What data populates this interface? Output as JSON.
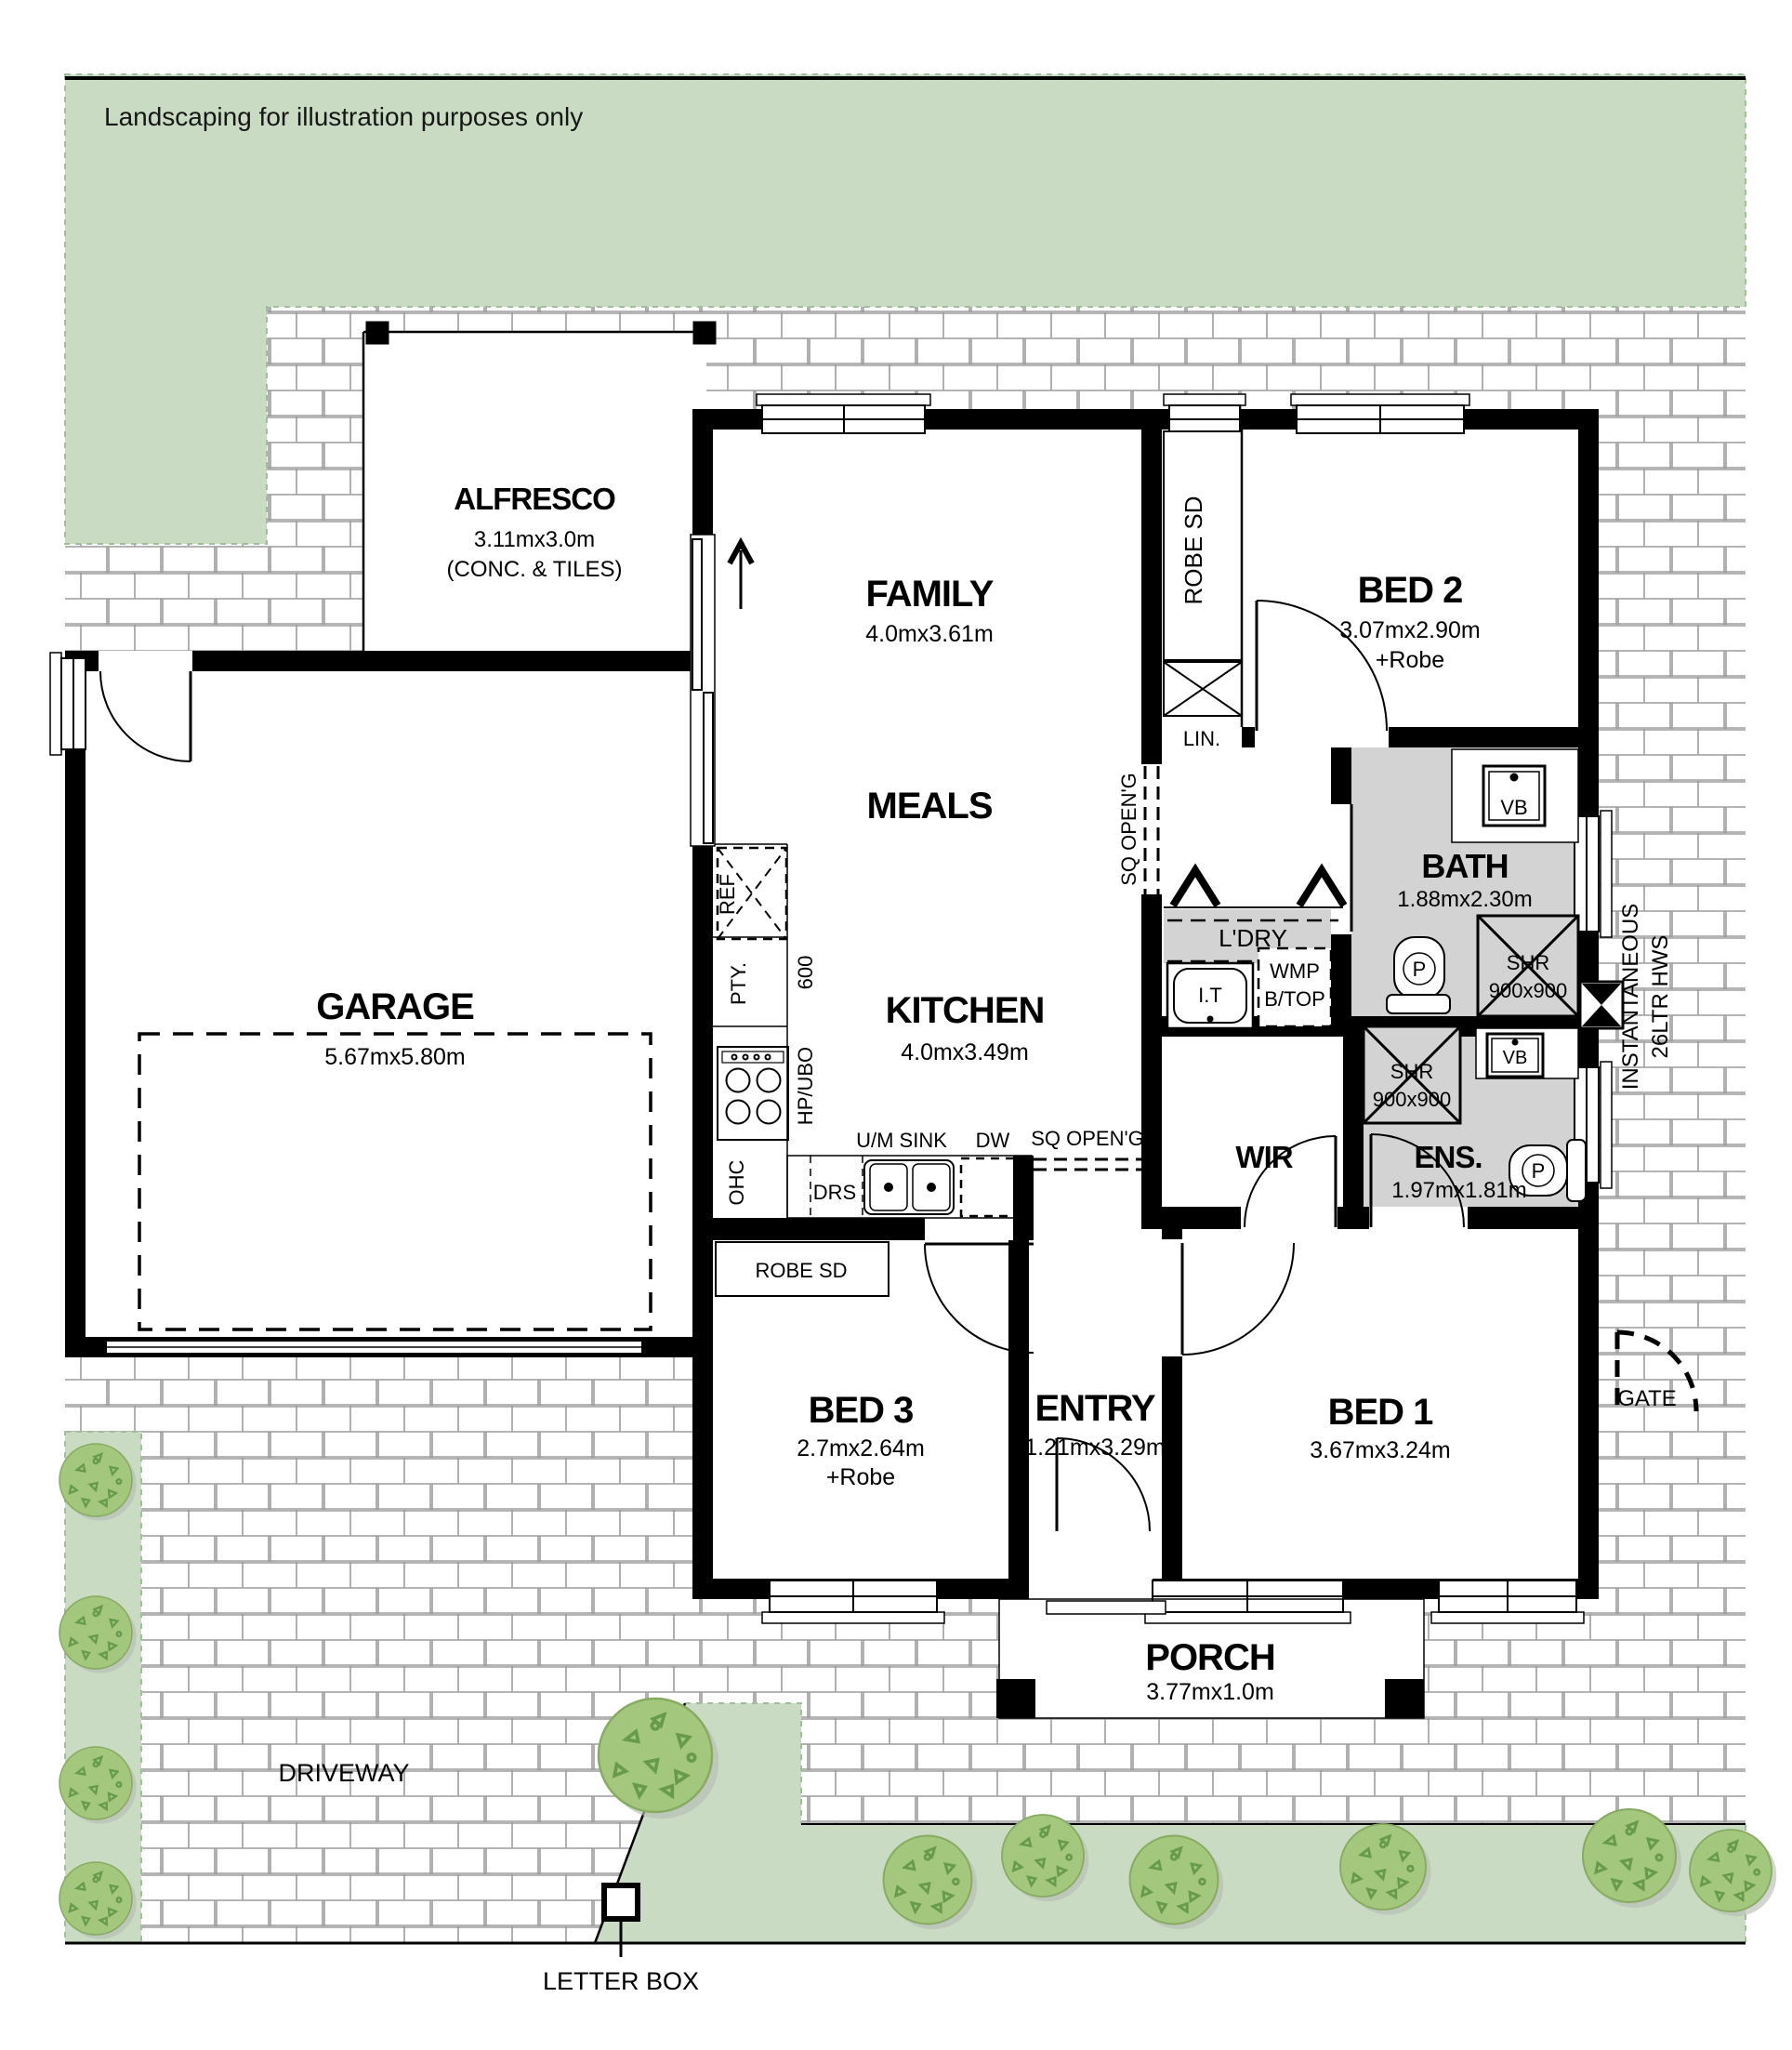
{
  "page": {
    "landscaping_note": "Landscaping for illustration purposes only"
  },
  "rooms": {
    "alfresco": {
      "name": "ALFRESCO",
      "dims": "3.11mx3.0m",
      "note": "(CONC. & TILES)"
    },
    "family": {
      "name": "FAMILY",
      "dims": "4.0mx3.61m"
    },
    "meals": {
      "name": "MEALS"
    },
    "kitchen": {
      "name": "KITCHEN",
      "dims": "4.0mx3.49m"
    },
    "garage": {
      "name": "GARAGE",
      "dims": "5.67mx5.80m"
    },
    "bed1": {
      "name": "BED 1",
      "dims": "3.67mx3.24m"
    },
    "bed2": {
      "name": "BED 2",
      "dims": "3.07mx2.90m",
      "extra": "+Robe"
    },
    "bed3": {
      "name": "BED 3",
      "dims": "2.7mx2.64m",
      "extra": "+Robe"
    },
    "entry": {
      "name": "ENTRY",
      "dims": "1.21mx3.29m"
    },
    "porch": {
      "name": "PORCH",
      "dims": "3.77mx1.0m"
    },
    "bath": {
      "name": "BATH",
      "dims": "1.88mx2.30m"
    },
    "ens": {
      "name": "ENS.",
      "dims": "1.97mx1.81m"
    },
    "wir": {
      "name": "WIR"
    },
    "ldry": {
      "name": "L'DRY"
    }
  },
  "fixtures": {
    "robe_sd": "ROBE SD",
    "lin": "LIN.",
    "sq_opening": "SQ OPEN'G",
    "ref": "REF",
    "pty": "PTY.",
    "bench_600": "600",
    "hp_ubo": "HP/UBO",
    "ohc": "OHC",
    "drs": "DRS",
    "um_sink": "U/M SINK",
    "dw": "DW",
    "vb": "VB",
    "p": "P",
    "shr": "SHR",
    "shr_size": "900x900",
    "it": "I.T",
    "wmp": "WMP",
    "btop": "B/TOP",
    "hws_line1": "INSTANTANEOUS",
    "hws_line2": "26LTR HWS"
  },
  "outside": {
    "driveway": "DRIVEWAY",
    "letter_box": "LETTER BOX",
    "gate": "GATE"
  },
  "colors": {
    "lawn": "#c9dcc3",
    "lawn_edge": "#9fbf9a",
    "wet": "#d3d3d3",
    "tree": "#a3c77c",
    "tree_detail": "#679b4b",
    "paver_line": "#9c9c9c",
    "wall": "#000000"
  }
}
